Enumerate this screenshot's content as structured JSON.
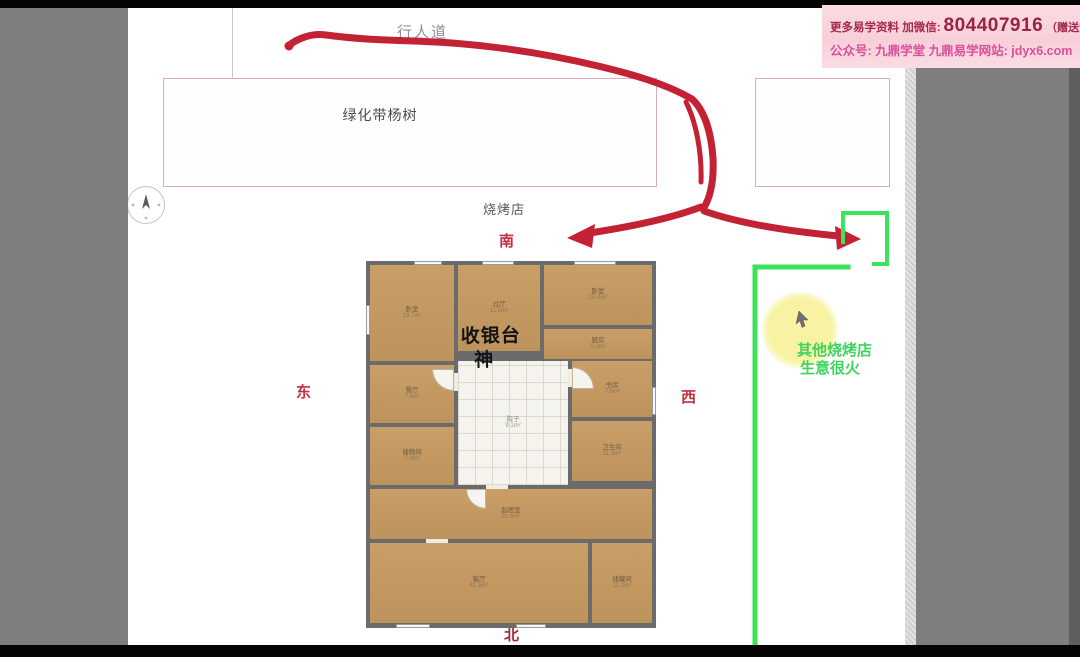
{
  "banner": {
    "line1_prefix": "更多易学资料 加微信:",
    "line1_number": "804407916",
    "line1_suffix": "（赠送资料）",
    "line2": "公众号: 九鼎学堂 九鼎易学网站: jdyx6.com",
    "background_pink": "#f8cfd9",
    "text_crimson": "#a5294e",
    "text_magenta": "#d8509c"
  },
  "street": {
    "walkway_label": "行人道",
    "green_belt_label": "绿化带杨树",
    "bbq_shop_label": "烧烤店"
  },
  "compass": {
    "south": "南",
    "east": "东",
    "west": "西",
    "north": "北"
  },
  "marker_notes": {
    "cashier_line1": "收银台",
    "cashier_line2": "神",
    "green_note_line1": "其他烧烤店",
    "green_note_line2": "生意很火"
  },
  "rooms": [
    {
      "label": "卧室",
      "area": "13.7m²"
    },
    {
      "label": "过厅",
      "area": "11.5m²"
    },
    {
      "label": "卧室",
      "area": "15.4m²"
    },
    {
      "label": "厨房",
      "area": "5.3m²"
    },
    {
      "label": "餐厅",
      "area": "7.5m²"
    },
    {
      "label": "储物间",
      "area": "7.9m²"
    },
    {
      "label": "书房",
      "area": "7.9m²"
    },
    {
      "label": "卫生间",
      "area": "11.3m²"
    },
    {
      "label": "院子",
      "area": "9.1m²"
    },
    {
      "label": "起居室",
      "area": "21.6m²"
    },
    {
      "label": "客厅",
      "area": "41.5m²"
    },
    {
      "label": "储藏间",
      "area": "11.2m²"
    }
  ],
  "colors": {
    "annotation_red": "#c32134",
    "annotation_green": "#3be25a",
    "room_tan": "#c49a63",
    "wall_gray": "#6b6b6b",
    "highlight_yellow": "#f7f3a2"
  }
}
